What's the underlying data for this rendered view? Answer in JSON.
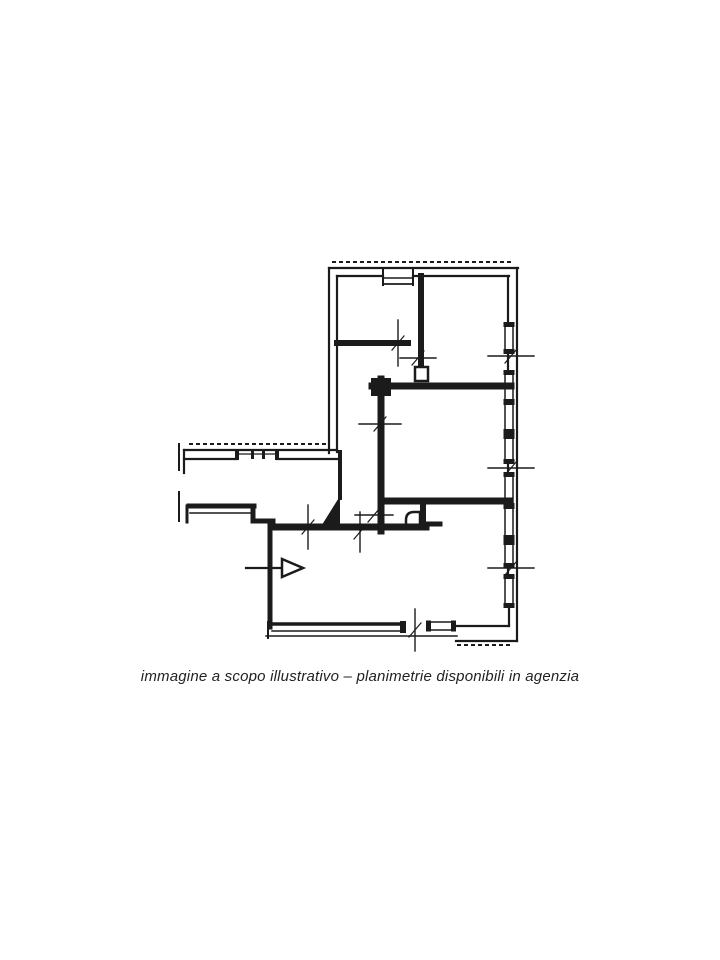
{
  "caption": {
    "text": "immagine a scopo illustrativo – planimetrie disponibili in agenzia"
  },
  "colors": {
    "ink": "#1b1b1b",
    "background": "#ffffff"
  },
  "plan": {
    "viewbox": "0 0 720 960",
    "elements": [
      {
        "t": "dash",
        "p": [
          333,
          262,
          515,
          262
        ],
        "w": 2,
        "n": "hatch-top-wall"
      },
      {
        "t": "dash",
        "p": [
          190,
          444,
          330,
          444
        ],
        "w": 2,
        "n": "hatch-corridor-wall"
      },
      {
        "t": "dash",
        "p": [
          458,
          645,
          514,
          645
        ],
        "w": 2,
        "n": "hatch-bottom-wall"
      },
      {
        "t": "line",
        "p": [
          329,
          268,
          518,
          268
        ],
        "w": 2.2,
        "n": "wall-outer-top"
      },
      {
        "t": "line",
        "p": [
          337,
          276,
          383,
          276
        ],
        "w": 2.2,
        "n": "wall-outer-top-inner"
      },
      {
        "t": "line",
        "p": [
          413,
          276,
          509,
          276
        ],
        "w": 2.2,
        "n": "wall-outer-top-inner"
      },
      {
        "t": "line",
        "p": [
          383,
          268,
          383,
          285
        ],
        "w": 2,
        "n": "window-top-jamb"
      },
      {
        "t": "line",
        "p": [
          413,
          268,
          413,
          285
        ],
        "w": 2,
        "n": "window-top-jamb"
      },
      {
        "t": "line",
        "p": [
          384,
          278,
          412,
          278
        ],
        "w": 1.4,
        "n": "window-top"
      },
      {
        "t": "line",
        "p": [
          384,
          284,
          412,
          284
        ],
        "w": 1.8,
        "n": "window-top"
      },
      {
        "t": "line",
        "p": [
          329,
          268,
          329,
          453
        ],
        "w": 2.2,
        "n": "wall-outer-left"
      },
      {
        "t": "line",
        "p": [
          337,
          276,
          337,
          452
        ],
        "w": 2.2,
        "n": "wall-outer-left-inner"
      },
      {
        "t": "line",
        "p": [
          184,
          450,
          337,
          450
        ],
        "w": 2.2,
        "n": "wall-corridor-top"
      },
      {
        "t": "line",
        "p": [
          184,
          459,
          237,
          459
        ],
        "w": 2.2,
        "n": "wall-corridor-top-inner"
      },
      {
        "t": "line",
        "p": [
          277,
          459,
          337,
          459
        ],
        "w": 2.2,
        "n": "wall-corridor-top-inner"
      },
      {
        "t": "line",
        "p": [
          237,
          454,
          277,
          454
        ],
        "w": 1.3,
        "n": "window-corridor"
      },
      {
        "t": "frect",
        "p": [
          235,
          450,
          4,
          10
        ],
        "n": "window-cap"
      },
      {
        "t": "frect",
        "p": [
          275,
          450,
          4,
          10
        ],
        "n": "window-cap"
      },
      {
        "t": "frect",
        "p": [
          251,
          451,
          3,
          8
        ],
        "n": "window-cap"
      },
      {
        "t": "frect",
        "p": [
          262,
          451,
          3,
          8
        ],
        "n": "window-cap"
      },
      {
        "t": "line",
        "p": [
          179,
          444,
          179,
          470
        ],
        "w": 2,
        "n": "wall-fragment-left"
      },
      {
        "t": "line",
        "p": [
          179,
          492,
          179,
          521
        ],
        "w": 2,
        "n": "wall-fragment-left"
      },
      {
        "t": "line",
        "p": [
          184,
          450,
          184,
          473
        ],
        "w": 2.2,
        "n": "wall-fragment-left"
      },
      {
        "t": "line",
        "p": [
          189,
          506,
          254,
          506
        ],
        "w": 5,
        "n": "wall-corridor-bottom"
      },
      {
        "t": "line",
        "p": [
          190,
          513,
          250,
          513
        ],
        "w": 1.5,
        "n": "wall-corridor-bottom-inner"
      },
      {
        "t": "line",
        "p": [
          253,
          506,
          253,
          521
        ],
        "w": 5,
        "n": "wall-step"
      },
      {
        "t": "line",
        "p": [
          253,
          521,
          273,
          521
        ],
        "w": 5,
        "n": "wall-step"
      },
      {
        "t": "line",
        "p": [
          187,
          506,
          187,
          522
        ],
        "w": 3,
        "n": "wall-fragment-left"
      },
      {
        "t": "line",
        "p": [
          517,
          268,
          517,
          641
        ],
        "w": 2.2,
        "n": "wall-outer-right"
      },
      {
        "t": "line",
        "p": [
          508,
          276,
          508,
          324
        ],
        "w": 2.2,
        "n": "wall-outer-right-inner"
      },
      {
        "t": "line",
        "p": [
          508,
          352,
          508,
          372
        ],
        "w": 2.2,
        "n": "wall-outer-right-inner"
      },
      {
        "t": "line",
        "p": [
          508,
          462,
          508,
          474
        ],
        "w": 2.2,
        "n": "wall-outer-right-inner"
      },
      {
        "t": "line",
        "p": [
          508,
          566,
          508,
          576
        ],
        "w": 2.2,
        "n": "wall-outer-right-inner"
      },
      {
        "t": "line",
        "p": [
          509,
          606,
          509,
          626
        ],
        "w": 2.2,
        "n": "wall-outer-right-inner"
      },
      {
        "t": "vwin",
        "x": 505,
        "y0": 324,
        "y1": 352,
        "n": "window-right"
      },
      {
        "t": "vwin",
        "x": 505,
        "y0": 372,
        "y1": 402,
        "n": "window-right"
      },
      {
        "t": "vwin",
        "x": 505,
        "y0": 402,
        "y1": 432,
        "n": "window-right"
      },
      {
        "t": "vwin",
        "x": 505,
        "y0": 436,
        "y1": 462,
        "n": "window-right"
      },
      {
        "t": "vwin",
        "x": 505,
        "y0": 474,
        "y1": 506,
        "n": "window-right"
      },
      {
        "t": "vwin",
        "x": 505,
        "y0": 506,
        "y1": 538,
        "n": "window-right"
      },
      {
        "t": "vwin",
        "x": 505,
        "y0": 542,
        "y1": 566,
        "n": "window-right"
      },
      {
        "t": "vwin",
        "x": 505,
        "y0": 576,
        "y1": 606,
        "n": "window-right"
      },
      {
        "t": "line",
        "p": [
          272,
          624,
          404,
          624
        ],
        "w": 3.5,
        "n": "window-balcony-bottom"
      },
      {
        "t": "line",
        "p": [
          272,
          631,
          404,
          631
        ],
        "w": 1.5,
        "n": "window-balcony-bottom"
      },
      {
        "t": "line",
        "p": [
          268,
          622,
          268,
          638
        ],
        "w": 2,
        "n": "wall-corner-bottom-left"
      },
      {
        "t": "frect",
        "p": [
          400,
          621,
          6,
          12
        ],
        "n": "window-cap"
      },
      {
        "t": "line",
        "p": [
          266,
          636,
          457,
          636
        ],
        "w": 1.5,
        "n": "wall-bottom-outer-line"
      },
      {
        "t": "hwin",
        "y": 622,
        "x0": 428,
        "x1": 454,
        "n": "window-bottom"
      },
      {
        "t": "line",
        "p": [
          456,
          641,
          517,
          641
        ],
        "w": 2.2,
        "n": "wall-bottom-right"
      },
      {
        "t": "line",
        "p": [
          456,
          626,
          509,
          626
        ],
        "w": 2.2,
        "n": "wall-bottom-right-inner"
      },
      {
        "t": "line",
        "p": [
          337,
          343,
          408,
          343
        ],
        "w": 6,
        "n": "wall-interior"
      },
      {
        "t": "line",
        "p": [
          421,
          276,
          421,
          367
        ],
        "w": 6,
        "n": "wall-interior"
      },
      {
        "t": "rect",
        "p": [
          415,
          367,
          13,
          14
        ],
        "sw": 2.5,
        "n": "wall-post"
      },
      {
        "t": "line",
        "p": [
          372,
          386,
          511,
          386
        ],
        "w": 7,
        "n": "wall-interior"
      },
      {
        "t": "frect",
        "p": [
          371,
          378,
          20,
          18
        ],
        "n": "wall-post"
      },
      {
        "t": "line",
        "p": [
          381,
          379,
          381,
          531
        ],
        "w": 7,
        "n": "wall-interior"
      },
      {
        "t": "line",
        "p": [
          381,
          501,
          509,
          501
        ],
        "w": 7,
        "n": "wall-interior"
      },
      {
        "t": "line",
        "p": [
          423,
          501,
          423,
          527
        ],
        "w": 6,
        "n": "wall-interior"
      },
      {
        "t": "line",
        "p": [
          423,
          524,
          440,
          524
        ],
        "w": 5,
        "n": "wall-interior"
      },
      {
        "t": "path",
        "d": "M406,527 L406,520 Q406,512 414,512 L420,512 L420,527 Z",
        "sw": 2.5,
        "f": "white",
        "n": "fixture-rounded-corner"
      },
      {
        "t": "line",
        "p": [
          340,
          452,
          340,
          498
        ],
        "w": 4,
        "n": "wall-interior"
      },
      {
        "t": "poly",
        "pts": "340,496 340,528 320,528",
        "f": "ink",
        "n": "door-triangle-marker"
      },
      {
        "t": "line",
        "p": [
          272,
          527,
          426,
          527
        ],
        "w": 7,
        "n": "wall-interior"
      },
      {
        "t": "line",
        "p": [
          270,
          524,
          270,
          627
        ],
        "w": 5,
        "n": "wall-room-left"
      },
      {
        "t": "tickv",
        "x": 398,
        "y": 343,
        "len": 46,
        "n": "tick-mark"
      },
      {
        "t": "tickh",
        "x": 418,
        "y": 358,
        "len": 36,
        "n": "tick-mark"
      },
      {
        "t": "tickh",
        "x": 511,
        "y": 356,
        "len": 46,
        "n": "tick-mark"
      },
      {
        "t": "tickh",
        "x": 511,
        "y": 468,
        "len": 46,
        "n": "tick-mark"
      },
      {
        "t": "tickh",
        "x": 511,
        "y": 568,
        "len": 46,
        "n": "tick-mark"
      },
      {
        "t": "tickh",
        "x": 380,
        "y": 424,
        "len": 42,
        "n": "tick-mark"
      },
      {
        "t": "tickh",
        "x": 374,
        "y": 515,
        "len": 38,
        "n": "tick-mark"
      },
      {
        "t": "tickv",
        "x": 308,
        "y": 527,
        "len": 44,
        "n": "tick-mark"
      },
      {
        "t": "tickv",
        "x": 360,
        "y": 532,
        "len": 40,
        "n": "tick-mark"
      },
      {
        "t": "tickv",
        "x": 415,
        "y": 630,
        "len": 42,
        "n": "tick-mark"
      },
      {
        "t": "line",
        "p": [
          246,
          568,
          282,
          568
        ],
        "w": 2.2,
        "n": "entrance-arrow-shaft"
      },
      {
        "t": "poly",
        "pts": "282,559 282,577 303,568",
        "f": "white",
        "sw": 2.5,
        "n": "entrance-arrow-head"
      }
    ]
  }
}
